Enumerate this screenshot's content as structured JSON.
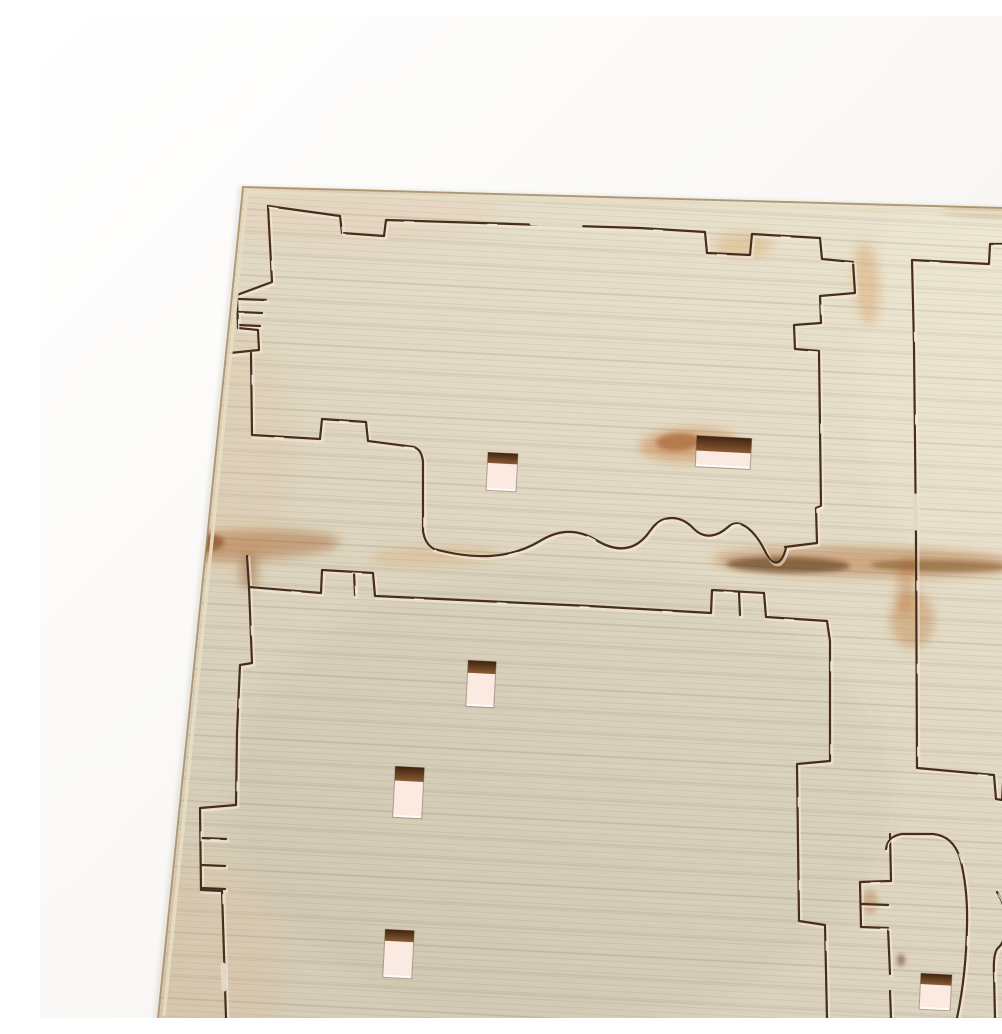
{
  "meta": {
    "description": "Photo of a light beige laser-cut plywood kit sheet on a white background, tilted, with cut part outlines, finger-joint combs, six small rectangular cut-out holes with scorched edges, and brown burn streaks",
    "width": 1002,
    "height": 1002
  },
  "palette": {
    "bg_top": "#ffffff",
    "bg_bottom": "#f4f1ec",
    "wood_light": "#ede6d2",
    "wood_mid": "#e1d9c4",
    "wood_dark": "#d2cab4",
    "grain_line_fine": "rgba(110,95,62,0.10)",
    "grain_line_coarse": "rgba(95,80,52,0.09)",
    "grain_line_light": "rgba(255,255,255,0.07)",
    "cut_dark": "#472e1a",
    "cut_glow": "#f7e9df",
    "cut_glint": "#fff6ef",
    "edge_line": "#a58a60",
    "edge_face": "#e6dcc2",
    "edge_shadow": "rgba(140,130,110,0.30)",
    "hole_fill": "#fbeae2",
    "hole_burn_dark": "#3f2410",
    "hole_burn_light": "#8a5a33",
    "bridge_fill": "#e1d9c4"
  },
  "sheet": {
    "clip_points": "203,171 1002,193 1002,1002 118,1002",
    "outer_edge_path": "M 118 1002 L 203 171 L 1002 193",
    "inner_face_path": "M 124 1000 L 207 176 L 1000 198"
  },
  "stains": [
    {
      "cx": 180,
      "cy": 430,
      "rx": 75,
      "ry": 130,
      "rot": 0,
      "fill": "rgba(232,180,140,0.16)",
      "blur": "b10"
    },
    {
      "cx": 160,
      "cy": 950,
      "rx": 85,
      "ry": 110,
      "rot": 0,
      "fill": "rgba(230,175,135,0.15)",
      "blur": "b10"
    },
    {
      "cx": 320,
      "cy": 195,
      "rx": 140,
      "ry": 35,
      "rot": -2,
      "fill": "rgba(235,185,150,0.12)",
      "blur": "b10"
    },
    {
      "cx": 520,
      "cy": 780,
      "rx": 330,
      "ry": 230,
      "rot": 0,
      "fill": "rgba(105,98,70,0.05)",
      "blur": "b10"
    },
    {
      "cx": 940,
      "cy": 350,
      "rx": 120,
      "ry": 220,
      "rot": 0,
      "fill": "rgba(255,252,240,0.10)",
      "blur": "b10"
    }
  ],
  "scorches": [
    {
      "cx": 205,
      "cy": 529,
      "rx": 95,
      "ry": 15,
      "rot": -2,
      "fill": "rgba(158,82,24,0.40)",
      "blur": "b6"
    },
    {
      "cx": 152,
      "cy": 527,
      "rx": 32,
      "ry": 11,
      "rot": -2,
      "fill": "rgba(122,58,14,0.55)",
      "blur": "b3"
    },
    {
      "cx": 133,
      "cy": 534,
      "rx": 26,
      "ry": 34,
      "rot": 0,
      "fill": "rgba(150,76,22,0.45)",
      "blur": "b6"
    },
    {
      "cx": 395,
      "cy": 540,
      "rx": 65,
      "ry": 10,
      "rot": -2,
      "fill": "rgba(205,135,60,0.22)",
      "blur": "b6"
    },
    {
      "cx": 209,
      "cy": 556,
      "rx": 9,
      "ry": 18,
      "rot": 0,
      "fill": "rgba(140,70,20,0.40)",
      "blur": "b6"
    },
    {
      "cx": 649,
      "cy": 429,
      "rx": 50,
      "ry": 17,
      "rot": -2,
      "fill": "rgba(196,116,42,0.42)",
      "blur": "b6"
    },
    {
      "cx": 638,
      "cy": 426,
      "rx": 22,
      "ry": 9,
      "rot": -2,
      "fill": "rgba(150,72,20,0.50)",
      "blur": "b3"
    },
    {
      "cx": 828,
      "cy": 546,
      "rx": 155,
      "ry": 15,
      "rot": 1,
      "fill": "rgba(170,92,30,0.38)",
      "blur": "b6"
    },
    {
      "cx": 748,
      "cy": 549,
      "rx": 62,
      "ry": 8,
      "rot": 1,
      "fill": "rgba(66,32,9,0.50)",
      "blur": "b3"
    },
    {
      "cx": 900,
      "cy": 550,
      "rx": 70,
      "ry": 6,
      "rot": 1,
      "fill": "rgba(92,46,14,0.40)",
      "blur": "b3"
    },
    {
      "cx": 872,
      "cy": 604,
      "rx": 22,
      "ry": 28,
      "rot": 0,
      "fill": "rgba(186,108,40,0.35)",
      "blur": "b6"
    },
    {
      "cx": 866,
      "cy": 570,
      "rx": 9,
      "ry": 30,
      "rot": 3,
      "fill": "rgba(175,95,30,0.30)",
      "blur": "b6"
    },
    {
      "cx": 827,
      "cy": 268,
      "rx": 13,
      "ry": 42,
      "rot": -4,
      "fill": "rgba(205,132,58,0.30)",
      "blur": "b6"
    },
    {
      "cx": 703,
      "cy": 229,
      "rx": 30,
      "ry": 13,
      "rot": -2,
      "fill": "rgba(208,140,62,0.28)",
      "blur": "b6"
    },
    {
      "cx": 960,
      "cy": 196,
      "rx": 60,
      "ry": 6,
      "rot": 1,
      "fill": "rgba(160,100,50,0.25)",
      "blur": "b3"
    },
    {
      "cx": 830,
      "cy": 886,
      "rx": 8,
      "ry": 12,
      "rot": 0,
      "fill": "rgba(170,95,30,0.30)",
      "blur": "b3"
    },
    {
      "cx": 861,
      "cy": 944,
      "rx": 4,
      "ry": 6,
      "rot": 0,
      "fill": "rgba(90,45,15,0.50)",
      "blur": "b3"
    }
  ],
  "cuts": {
    "paths": [
      {
        "name": "panel1-top-edge-and-right-stair",
        "d": "M 228 190 L 300 200 L 302 217 L 344 220 L 346 204 L 600 212 L 665 216 L 667 237 L 710 239 L 712 218 L 780 222 L 782 243 L 813 246 L 815 277 L 780 280 L 781 307 L 754 309 L 755 333 L 779 335 L 781 490 L 776 492 L 777 527 L 745 531"
      },
      {
        "name": "panel1-left-edge-comb",
        "d": "M 228 190 L 232 266 L 197 279 L 198 312 L 218 314 L 219 334 L 190 337"
      },
      {
        "name": "panel1-left-slit-1",
        "d": "M 199 283 L 226 284"
      },
      {
        "name": "panel1-left-slit-2",
        "d": "M 198 296 L 222 297"
      },
      {
        "name": "panel1-left-slit-3",
        "d": "M 198 309 L 220 310"
      },
      {
        "name": "panel1-bottom-edge-with-tab",
        "d": "M 211 337 L 212 419 L 280 423 L 282 403 L 326 406 L 328 425 L 374 431 Q 382 434 383 446 L 383 515 Q 385 528 394 533"
      },
      {
        "name": "panel1-bottom-wave",
        "d": "M 394 533 C 435 544 470 543 500 525 C 518 514 536 512 556 524 C 574 535 594 538 610 515 C 622 497 641 499 654 513 C 665 524 678 520 688 511 C 700 500 716 516 726 537 C 733 550 741 551 746 532"
      },
      {
        "name": "panel1-corner-stub",
        "d": "M 207 540 L 209 571"
      },
      {
        "name": "right-panel-top-edge",
        "d": "M 872 244 L 949 248 L 950 228 L 963 228 L 964 247 L 968 247 L 969 228 L 986 229 L 987 248 L 1002 249"
      },
      {
        "name": "right-panel-left-and-bottom-edge",
        "d": "M 872 244 L 874 330 L 876 520 L 877 752 L 954 759 L 956 783 L 962 784 L 963 768 L 970 768 L 971 786 L 975 786 L 975 769 L 989 769 L 990 787 L 1002 788"
      },
      {
        "name": "lower-panel-top-and-right-edge",
        "d": "M 209 571 L 281 577 L 282 554 L 333 557 L 335 580 L 549 590 L 671 597 L 672 574 L 724 577 L 726 601 L 787 605 L 790 625 L 790 745 L 757 748 L 759 905 L 785 909 L 787 1002"
      },
      {
        "name": "lower-panel-top-slit-a",
        "d": "M 314 556 L 315 579"
      },
      {
        "name": "lower-panel-top-slit-b",
        "d": "M 699 576 L 700 599"
      },
      {
        "name": "lower-panel-left-edge-comb",
        "d": "M 209 571 L 212 647 L 200 649 L 197 717 L 196 789 L 160 792 L 161 874 L 182 875 L 186 1002"
      },
      {
        "name": "lower-left-slit-1",
        "d": "M 161 822 L 186 823"
      },
      {
        "name": "lower-left-slit-2",
        "d": "M 161 849 L 185 850"
      },
      {
        "name": "lower-left-slit-3",
        "d": "M 161 872 L 185 873"
      },
      {
        "name": "bottom-curve-hook",
        "d": "M 846 833 Q 848 820 862 818 L 893 818 Q 913 820 920 842 Q 928 872 927 910 Q 926 960 917 1002"
      },
      {
        "name": "bottom-comb-e",
        "d": "M 850 818 L 851 865 L 820 866 L 821 911 L 848 912 L 850 958 M 850 975 L 851 1002"
      },
      {
        "name": "bottom-comb-e-slit",
        "d": "M 822 888 L 848 889"
      },
      {
        "name": "bottom-right-curve-1",
        "d": "M 957 876 Q 966 890 966 907 Q 966 925 958 932 Q 953 937 954 958 L 955 1002"
      },
      {
        "name": "bottom-right-curve-2",
        "d": "M 1001 869 Q 988 878 985 905 L 983 960 L 985 1002"
      }
    ]
  },
  "bridges": [
    {
      "d": "M 492 207 L 540 210"
    },
    {
      "d": "M 183 949 L 184 973"
    },
    {
      "d": "M 875 480 L 876 512"
    }
  ],
  "holes": [
    {
      "name": "cutout-hole-1",
      "x": 447,
      "y": 437,
      "w": 30,
      "h": 38,
      "rot": 3,
      "burn_frac": 0.28
    },
    {
      "name": "cutout-hole-2",
      "x": 656,
      "y": 421,
      "w": 55,
      "h": 31,
      "rot": 3,
      "burn_frac": 0.48
    },
    {
      "name": "cutout-hole-3",
      "x": 427,
      "y": 645,
      "w": 28,
      "h": 46,
      "rot": 3,
      "burn_frac": 0.27
    },
    {
      "name": "cutout-hole-4",
      "x": 354,
      "y": 751,
      "w": 29,
      "h": 51,
      "rot": 3,
      "burn_frac": 0.28
    },
    {
      "name": "cutout-hole-5",
      "x": 344,
      "y": 914,
      "w": 29,
      "h": 48,
      "rot": 3,
      "burn_frac": 0.24
    },
    {
      "name": "cutout-hole-6",
      "x": 880,
      "y": 958,
      "w": 31,
      "h": 36,
      "rot": 3,
      "burn_frac": 0.3
    }
  ]
}
